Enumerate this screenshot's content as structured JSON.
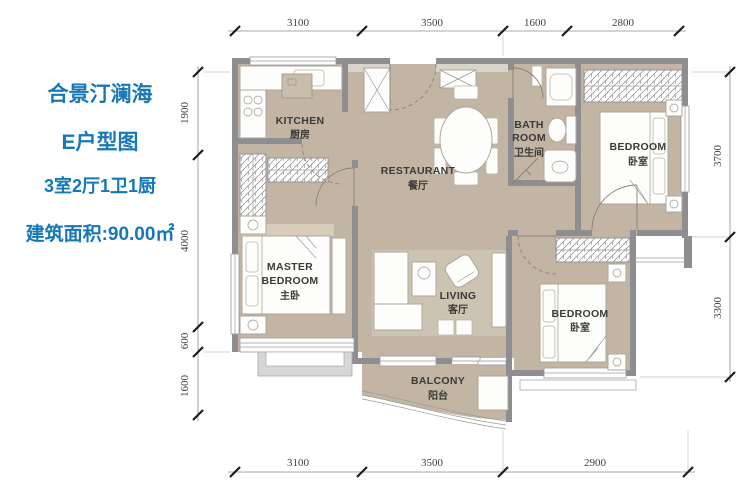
{
  "header": {
    "project": "合景汀澜海",
    "plan_name": "E户型图",
    "layout": "3室2厅1卫1厨",
    "area": "建筑面积:90.00㎡"
  },
  "rooms": {
    "kitchen": {
      "en": "KITCHEN",
      "zh": "厨房"
    },
    "restaurant": {
      "en": "RESTAURANT",
      "zh": "餐厅"
    },
    "bathroom": {
      "en_line1": "BATH",
      "en_line2": "ROOM",
      "zh": "卫生间"
    },
    "bedroom_right": {
      "en": "BEDROOM",
      "zh": "卧室"
    },
    "master_bedroom": {
      "en_line1": "MASTER",
      "en_line2": "BEDROOM",
      "zh": "主卧"
    },
    "living": {
      "en": "LIVING",
      "zh": "客厅"
    },
    "bedroom_bottom": {
      "en": "BEDROOM",
      "zh": "卧室"
    },
    "balcony": {
      "en": "BALCONY",
      "zh": "阳台"
    }
  },
  "dims": {
    "top": [
      "3100",
      "3500",
      "1600",
      "2800"
    ],
    "bottom": [
      "3100",
      "3500",
      "2900"
    ],
    "left": [
      "1900",
      "4000",
      "600",
      "1600"
    ],
    "right": [
      "3700",
      "3300"
    ]
  },
  "colors": {
    "accent_blue": "#1778b6",
    "floor_tan": "#c2b5a3",
    "wall_gray": "#8d8d92"
  }
}
